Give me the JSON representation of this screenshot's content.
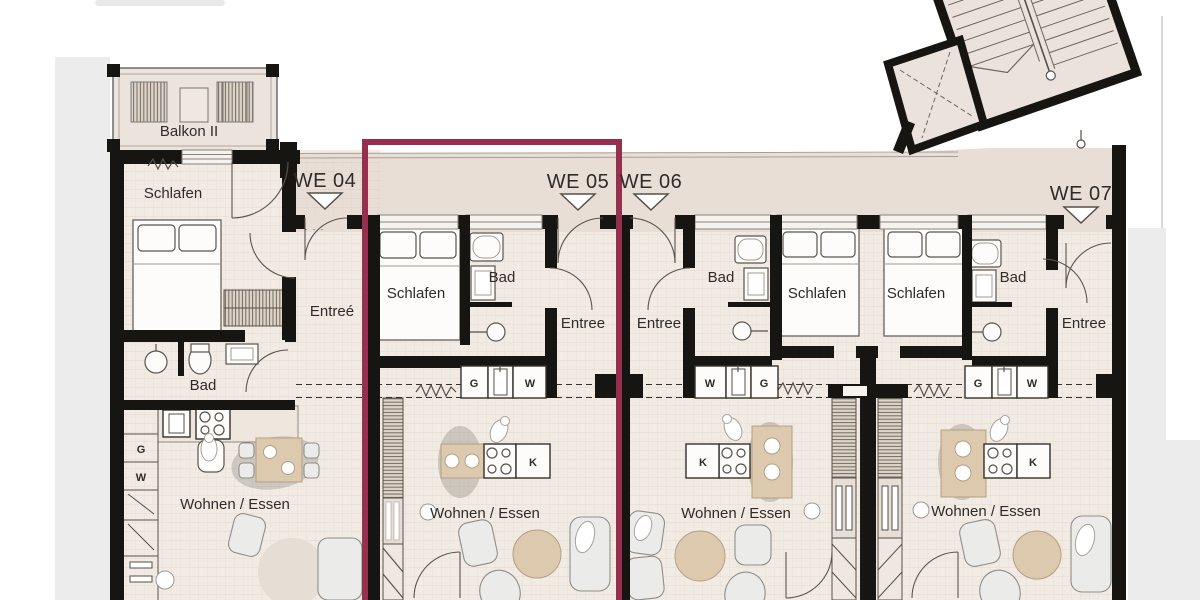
{
  "plan_name": "apartment-floor-plan",
  "highlight_color": "#97304e",
  "balcony": {
    "label": "Balkon II"
  },
  "units": [
    {
      "id": "WE04",
      "label": "WE 04",
      "schlafen": "Schlafen",
      "bad": "Bad",
      "entree": "Entreé",
      "living": "Wohnen / Essen",
      "closet_g": "G",
      "closet_w": "W"
    },
    {
      "id": "WE05",
      "label": "WE 05",
      "schlafen": "Schlafen",
      "bad": "Bad",
      "entree": "Entree",
      "living": "Wohnen / Essen",
      "closet_g": "G",
      "closet_w": "W",
      "kitchen_k": "K"
    },
    {
      "id": "WE06",
      "label": "WE 06",
      "schlafen": "Schlafen",
      "bad": "Bad",
      "entree": "Entree",
      "living": "Wohnen / Essen",
      "closet_g": "G",
      "closet_w": "W",
      "kitchen_k": "K"
    },
    {
      "id": "WE07",
      "label": "WE 07",
      "schlafen": "Schlafen",
      "bad": "Bad",
      "entree": "Entree",
      "living": "Wohnen / Essen",
      "closet_g": "G",
      "closet_w": "W",
      "kitchen_k": "K"
    }
  ]
}
